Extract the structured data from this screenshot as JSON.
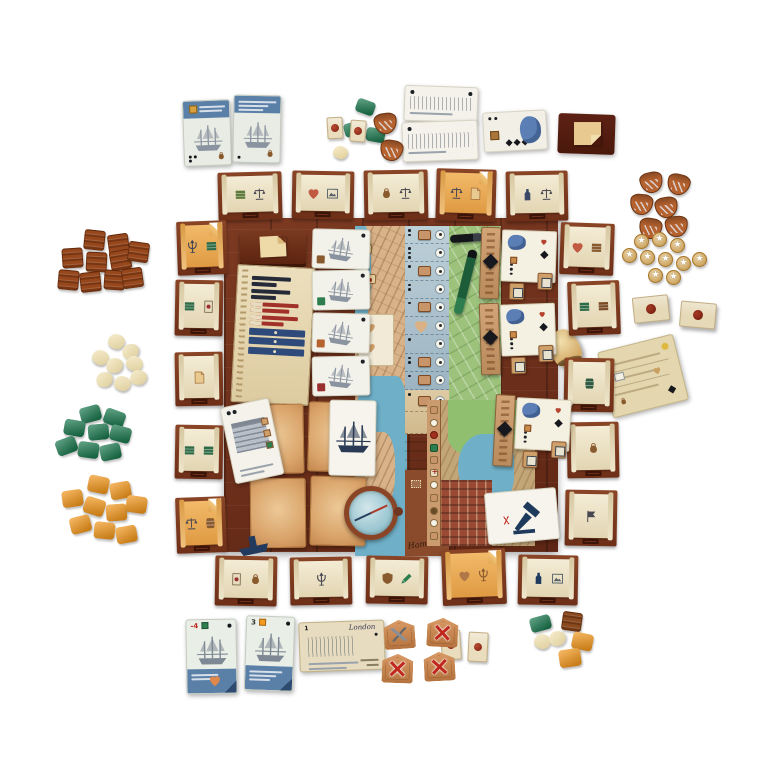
{
  "labels": {
    "hamburg": "Hamburg",
    "london": "London"
  },
  "cards": {
    "bottom_ship_a_value": "-4",
    "bottom_ship_b_value": "3",
    "london_value": "1"
  },
  "colors": {
    "board_wood": "#6e2f1c",
    "tile_wood": "#7d3a22",
    "parchment": "#ece2c4",
    "orange_tile": "#e9a958",
    "map_water": "#6fb0c8",
    "map_land": "#d8b288",
    "map_green": "#9cc27c",
    "track_blue": "#a9c0cd",
    "navy": "#1e3a5c",
    "card_blue": "#5b80a8",
    "green_piece": "#1d7a50",
    "orange_piece": "#f59a1f",
    "brown_piece": "#96471c",
    "cream_piece": "#f0dfa8",
    "coin_gold": "#d9a850",
    "seal_red": "#9e2c1c"
  },
  "edge_tiles": {
    "top": [
      {
        "x": 218,
        "y": 172,
        "w": 64,
        "h": 48,
        "r": -1.5,
        "v": "p",
        "ic": [
          {
            "n": "crate",
            "c": "#5d7a3a"
          },
          {
            "n": "scales",
            "c": "#474752"
          }
        ]
      },
      {
        "x": 292,
        "y": 171,
        "w": 62,
        "h": 48,
        "r": 1,
        "v": "p",
        "ic": [
          {
            "n": "heart",
            "c": "#c05a40"
          },
          {
            "n": "picture",
            "c": "#56606b"
          }
        ]
      },
      {
        "x": 364,
        "y": 170,
        "w": 64,
        "h": 50,
        "r": -1,
        "v": "p",
        "ic": [
          {
            "n": "bag",
            "c": "#8a5a2f"
          },
          {
            "n": "scales",
            "c": "#474752"
          }
        ]
      },
      {
        "x": 436,
        "y": 169,
        "w": 60,
        "h": 52,
        "r": 1.5,
        "v": "o",
        "ic": [
          {
            "n": "scales",
            "c": "#474752"
          },
          {
            "n": "paper",
            "c": "#a4703a"
          }
        ]
      },
      {
        "x": 506,
        "y": 171,
        "w": 62,
        "h": 50,
        "r": -1,
        "v": "p",
        "ic": [
          {
            "n": "bottle",
            "c": "#3a4a66"
          },
          {
            "n": "scales",
            "c": "#474752"
          }
        ]
      }
    ],
    "bottom": [
      {
        "x": 215,
        "y": 556,
        "w": 62,
        "h": 50,
        "r": 1,
        "v": "p",
        "ic": [
          {
            "n": "card",
            "c": "#9a3030"
          },
          {
            "n": "bag",
            "c": "#8a5a2f"
          }
        ]
      },
      {
        "x": 290,
        "y": 557,
        "w": 62,
        "h": 48,
        "r": -1,
        "v": "p",
        "ic": [
          {
            "n": "trident",
            "c": "#474752"
          }
        ]
      },
      {
        "x": 366,
        "y": 556,
        "w": 62,
        "h": 48,
        "r": 1,
        "v": "p",
        "ic": [
          {
            "n": "shield",
            "c": "#8a5a2f"
          },
          {
            "n": "pencil",
            "c": "#2e7d4f"
          }
        ]
      },
      {
        "x": 442,
        "y": 549,
        "w": 64,
        "h": 56,
        "r": -2,
        "v": "o",
        "ic": [
          {
            "n": "heart",
            "c": "#b07848"
          },
          {
            "n": "trident",
            "c": "#8a5a2f"
          }
        ]
      },
      {
        "x": 518,
        "y": 555,
        "w": 60,
        "h": 50,
        "r": 1,
        "v": "p",
        "ic": [
          {
            "n": "bottle",
            "c": "#1e3a5f"
          },
          {
            "n": "picture",
            "c": "#56606b"
          }
        ]
      }
    ],
    "left": [
      {
        "x": 177,
        "y": 221,
        "w": 50,
        "h": 54,
        "r": -2,
        "v": "o",
        "ic": [
          {
            "n": "trident",
            "c": "#474752"
          },
          {
            "n": "crate",
            "c": "#2e6b46"
          }
        ]
      },
      {
        "x": 175,
        "y": 280,
        "w": 48,
        "h": 56,
        "r": 1,
        "v": "p",
        "ic": [
          {
            "n": "crate",
            "c": "#2e6b46"
          },
          {
            "n": "card",
            "c": "#9a3030"
          }
        ]
      },
      {
        "x": 175,
        "y": 352,
        "w": 48,
        "h": 54,
        "r": -1,
        "v": "p",
        "ic": [
          {
            "n": "paper",
            "c": "#a4703a"
          }
        ]
      },
      {
        "x": 175,
        "y": 425,
        "w": 48,
        "h": 54,
        "r": 1,
        "v": "p",
        "ic": [
          {
            "n": "crate",
            "c": "#2e6b46"
          },
          {
            "n": "crate",
            "c": "#2e6b46"
          }
        ]
      },
      {
        "x": 176,
        "y": 497,
        "w": 50,
        "h": 56,
        "r": -2,
        "v": "o",
        "ic": [
          {
            "n": "scales",
            "c": "#474752"
          },
          {
            "n": "barrel",
            "c": "#8a5a2f"
          }
        ]
      }
    ],
    "right": [
      {
        "x": 560,
        "y": 223,
        "w": 54,
        "h": 52,
        "r": 2,
        "v": "p",
        "ic": [
          {
            "n": "heart",
            "c": "#c05a40"
          },
          {
            "n": "crate",
            "c": "#8a5a2f"
          }
        ]
      },
      {
        "x": 568,
        "y": 281,
        "w": 52,
        "h": 54,
        "r": -2,
        "v": "p",
        "ic": [
          {
            "n": "crate",
            "c": "#2e6b46"
          },
          {
            "n": "crate",
            "c": "#7a4a26"
          }
        ]
      },
      {
        "x": 564,
        "y": 358,
        "w": 50,
        "h": 54,
        "r": 1,
        "v": "p",
        "ic": [
          {
            "n": "barrel",
            "c": "#2e5a40"
          }
        ]
      },
      {
        "x": 567,
        "y": 422,
        "w": 52,
        "h": 56,
        "r": -1,
        "v": "p",
        "ic": [
          {
            "n": "bag",
            "c": "#8a5a2f"
          }
        ]
      },
      {
        "x": 565,
        "y": 490,
        "w": 52,
        "h": 56,
        "r": 1,
        "v": "p",
        "ic": [
          {
            "n": "flag",
            "c": "#474752"
          }
        ]
      }
    ]
  },
  "clusters": [
    {
      "name": "brown-crate-supply",
      "piece": "crate",
      "color": "#96471c",
      "w": 21,
      "h": 20,
      "x": 56,
      "y": 228,
      "items": [
        [
          28,
          2,
          6
        ],
        [
          52,
          6,
          -8
        ],
        [
          6,
          20,
          -4
        ],
        [
          30,
          24,
          3
        ],
        [
          54,
          22,
          -10
        ],
        [
          72,
          14,
          8
        ],
        [
          2,
          42,
          5
        ],
        [
          24,
          44,
          -6
        ],
        [
          48,
          42,
          4
        ],
        [
          66,
          40,
          -8
        ]
      ]
    },
    {
      "name": "cream-goods-supply",
      "piece": "blob",
      "color": "#f0dfa8",
      "w": 17,
      "h": 15,
      "x": 86,
      "y": 334,
      "items": [
        [
          22,
          0,
          10
        ],
        [
          36,
          10,
          -20
        ],
        [
          6,
          16,
          15
        ],
        [
          20,
          24,
          -10
        ],
        [
          40,
          22,
          20
        ],
        [
          10,
          38,
          -15
        ],
        [
          28,
          42,
          10
        ],
        [
          44,
          36,
          -5
        ]
      ]
    },
    {
      "name": "green-block-supply",
      "piece": "block",
      "color": "#1d7a50",
      "w": 21,
      "h": 16,
      "x": 50,
      "y": 406,
      "items": [
        [
          30,
          0,
          -15
        ],
        [
          54,
          4,
          20
        ],
        [
          14,
          14,
          10
        ],
        [
          38,
          18,
          -5
        ],
        [
          60,
          20,
          15
        ],
        [
          6,
          32,
          -20
        ],
        [
          28,
          36,
          8
        ],
        [
          50,
          38,
          -12
        ]
      ]
    },
    {
      "name": "orange-block-supply",
      "piece": "block",
      "color": "#f59a1f",
      "w": 21,
      "h": 17,
      "x": 60,
      "y": 476,
      "items": [
        [
          28,
          0,
          12
        ],
        [
          50,
          6,
          -10
        ],
        [
          2,
          14,
          -8
        ],
        [
          24,
          22,
          18
        ],
        [
          46,
          28,
          -4
        ],
        [
          66,
          20,
          8
        ],
        [
          10,
          40,
          -14
        ],
        [
          34,
          46,
          6
        ],
        [
          56,
          50,
          -10
        ]
      ]
    },
    {
      "name": "green-cubes-loose",
      "piece": "block",
      "color": "#1d7a50",
      "w": 19,
      "h": 14,
      "x": 340,
      "y": 100,
      "items": [
        [
          16,
          0,
          20
        ],
        [
          4,
          22,
          -15
        ],
        [
          26,
          28,
          10
        ]
      ]
    },
    {
      "name": "cream-piece-loose",
      "piece": "blob",
      "color": "#f2dfa4",
      "w": 15,
      "h": 13,
      "x": 333,
      "y": 146,
      "items": [
        [
          0,
          0,
          10
        ]
      ]
    },
    {
      "name": "seal-tokens-top",
      "piece": "sealcard",
      "color": "#e9ddbd",
      "w": 16,
      "h": 22,
      "x": 327,
      "y": 117,
      "items": [
        [
          0,
          0,
          -3
        ],
        [
          23,
          3,
          4
        ]
      ]
    },
    {
      "name": "purse-tokens-loose",
      "piece": "purse",
      "color": "#b5622f",
      "w": 23,
      "h": 21,
      "x": 374,
      "y": 113,
      "items": [
        [
          0,
          0,
          -8
        ],
        [
          6,
          27,
          10
        ]
      ]
    },
    {
      "name": "purse-supply",
      "piece": "purse",
      "color": "#b5622f",
      "w": 23,
      "h": 21,
      "x": 625,
      "y": 172,
      "items": [
        [
          15,
          0,
          -12
        ],
        [
          42,
          2,
          14
        ],
        [
          5,
          22,
          6
        ],
        [
          30,
          25,
          -10
        ],
        [
          14,
          46,
          9
        ],
        [
          40,
          44,
          -5
        ]
      ]
    },
    {
      "name": "coin-supply",
      "piece": "coin",
      "color": "#d9a850",
      "w": 15,
      "h": 15,
      "x": 618,
      "y": 232,
      "items": [
        [
          16,
          2,
          0
        ],
        [
          34,
          0,
          0
        ],
        [
          52,
          6,
          0
        ],
        [
          4,
          16,
          0
        ],
        [
          22,
          18,
          0
        ],
        [
          40,
          20,
          0
        ],
        [
          58,
          24,
          0
        ],
        [
          74,
          20,
          0
        ],
        [
          30,
          36,
          0
        ],
        [
          48,
          38,
          0
        ]
      ]
    },
    {
      "name": "seal-blocks-right",
      "piece": "sealblock",
      "color": "#e6d9b8",
      "w": 36,
      "h": 26,
      "x": 633,
      "y": 296,
      "items": [
        [
          0,
          0,
          -6
        ],
        [
          47,
          6,
          5
        ]
      ]
    },
    {
      "name": "seal-tiles-bottom",
      "piece": "sealcard",
      "color": "#e9ddbd",
      "w": 20,
      "h": 30,
      "x": 441,
      "y": 628,
      "items": [
        [
          0,
          2,
          -4
        ],
        [
          27,
          4,
          3
        ]
      ]
    },
    {
      "name": "damage-tokens",
      "piece": "xtoken",
      "color": "#c98a5a",
      "w": 31,
      "h": 29,
      "x": 382,
      "y": 618,
      "items": [
        {
          "dx": 2,
          "dy": 2,
          "rot": -4,
          "k": "tools"
        },
        {
          "dx": 45,
          "dy": 0,
          "rot": 3,
          "k": "x"
        },
        {
          "dx": 0,
          "dy": 36,
          "rot": 2,
          "k": "x"
        },
        {
          "dx": 42,
          "dy": 34,
          "rot": -3,
          "k": "x"
        }
      ]
    },
    {
      "name": "mixed-pieces-bottom",
      "piece": "mixed",
      "x": 528,
      "y": 612,
      "items": [
        {
          "dx": 2,
          "dy": 4,
          "rot": -15,
          "p": "block",
          "c": "#1d7a50",
          "w": 21,
          "h": 15
        },
        {
          "dx": 34,
          "dy": 0,
          "rot": 8,
          "p": "crate",
          "c": "#8a4a1f",
          "w": 20,
          "h": 19
        },
        {
          "dx": 6,
          "dy": 22,
          "rot": 10,
          "p": "blob",
          "c": "#f0dfa8",
          "w": 17,
          "h": 15
        },
        {
          "dx": 21,
          "dy": 19,
          "rot": -12,
          "p": "blob",
          "c": "#f0dfa8",
          "w": 17,
          "h": 15
        },
        {
          "dx": 44,
          "dy": 21,
          "rot": 12,
          "p": "block",
          "c": "#f59a1f",
          "w": 21,
          "h": 17
        },
        {
          "dx": 31,
          "dy": 37,
          "rot": -8,
          "p": "block",
          "c": "#f59a1f",
          "w": 22,
          "h": 18
        }
      ]
    }
  ],
  "track": {
    "blue_rows": [
      {
        "pips": 2,
        "token": "tag"
      },
      {
        "pips": 3,
        "token": null
      },
      {
        "pips": 1,
        "token": "tag"
      },
      {
        "pips": 2,
        "token": null
      },
      {
        "pips": 1,
        "token": "tag"
      },
      {
        "pips": 0,
        "token": "heart"
      },
      {
        "pips": 1,
        "token": null
      },
      {
        "pips": 2,
        "token": "tag"
      },
      {
        "pips": 1,
        "token": "tag"
      }
    ],
    "tan_rows": [
      {
        "pips": 1,
        "token": "tag"
      },
      {
        "pips": 0,
        "token": null
      }
    ]
  },
  "lower_track_icons": [
    "tag",
    "circle",
    "seal",
    "green",
    "tag",
    "cross",
    "circle",
    "tag",
    "dot",
    "circle",
    "tag"
  ],
  "contracts": [
    {
      "x": 480,
      "y": 228,
      "r": 2
    },
    {
      "x": 480,
      "y": 302,
      "r": -2
    },
    {
      "x": 494,
      "y": 396,
      "r": 3
    }
  ],
  "board_ship_cards": [
    {
      "y": 229,
      "mark": "#8a5a2f"
    },
    {
      "y": 270,
      "mark": "#2e7d4f"
    },
    {
      "y": 313,
      "mark": "#b5622f"
    },
    {
      "y": 356,
      "mark": "#9a3030"
    }
  ]
}
